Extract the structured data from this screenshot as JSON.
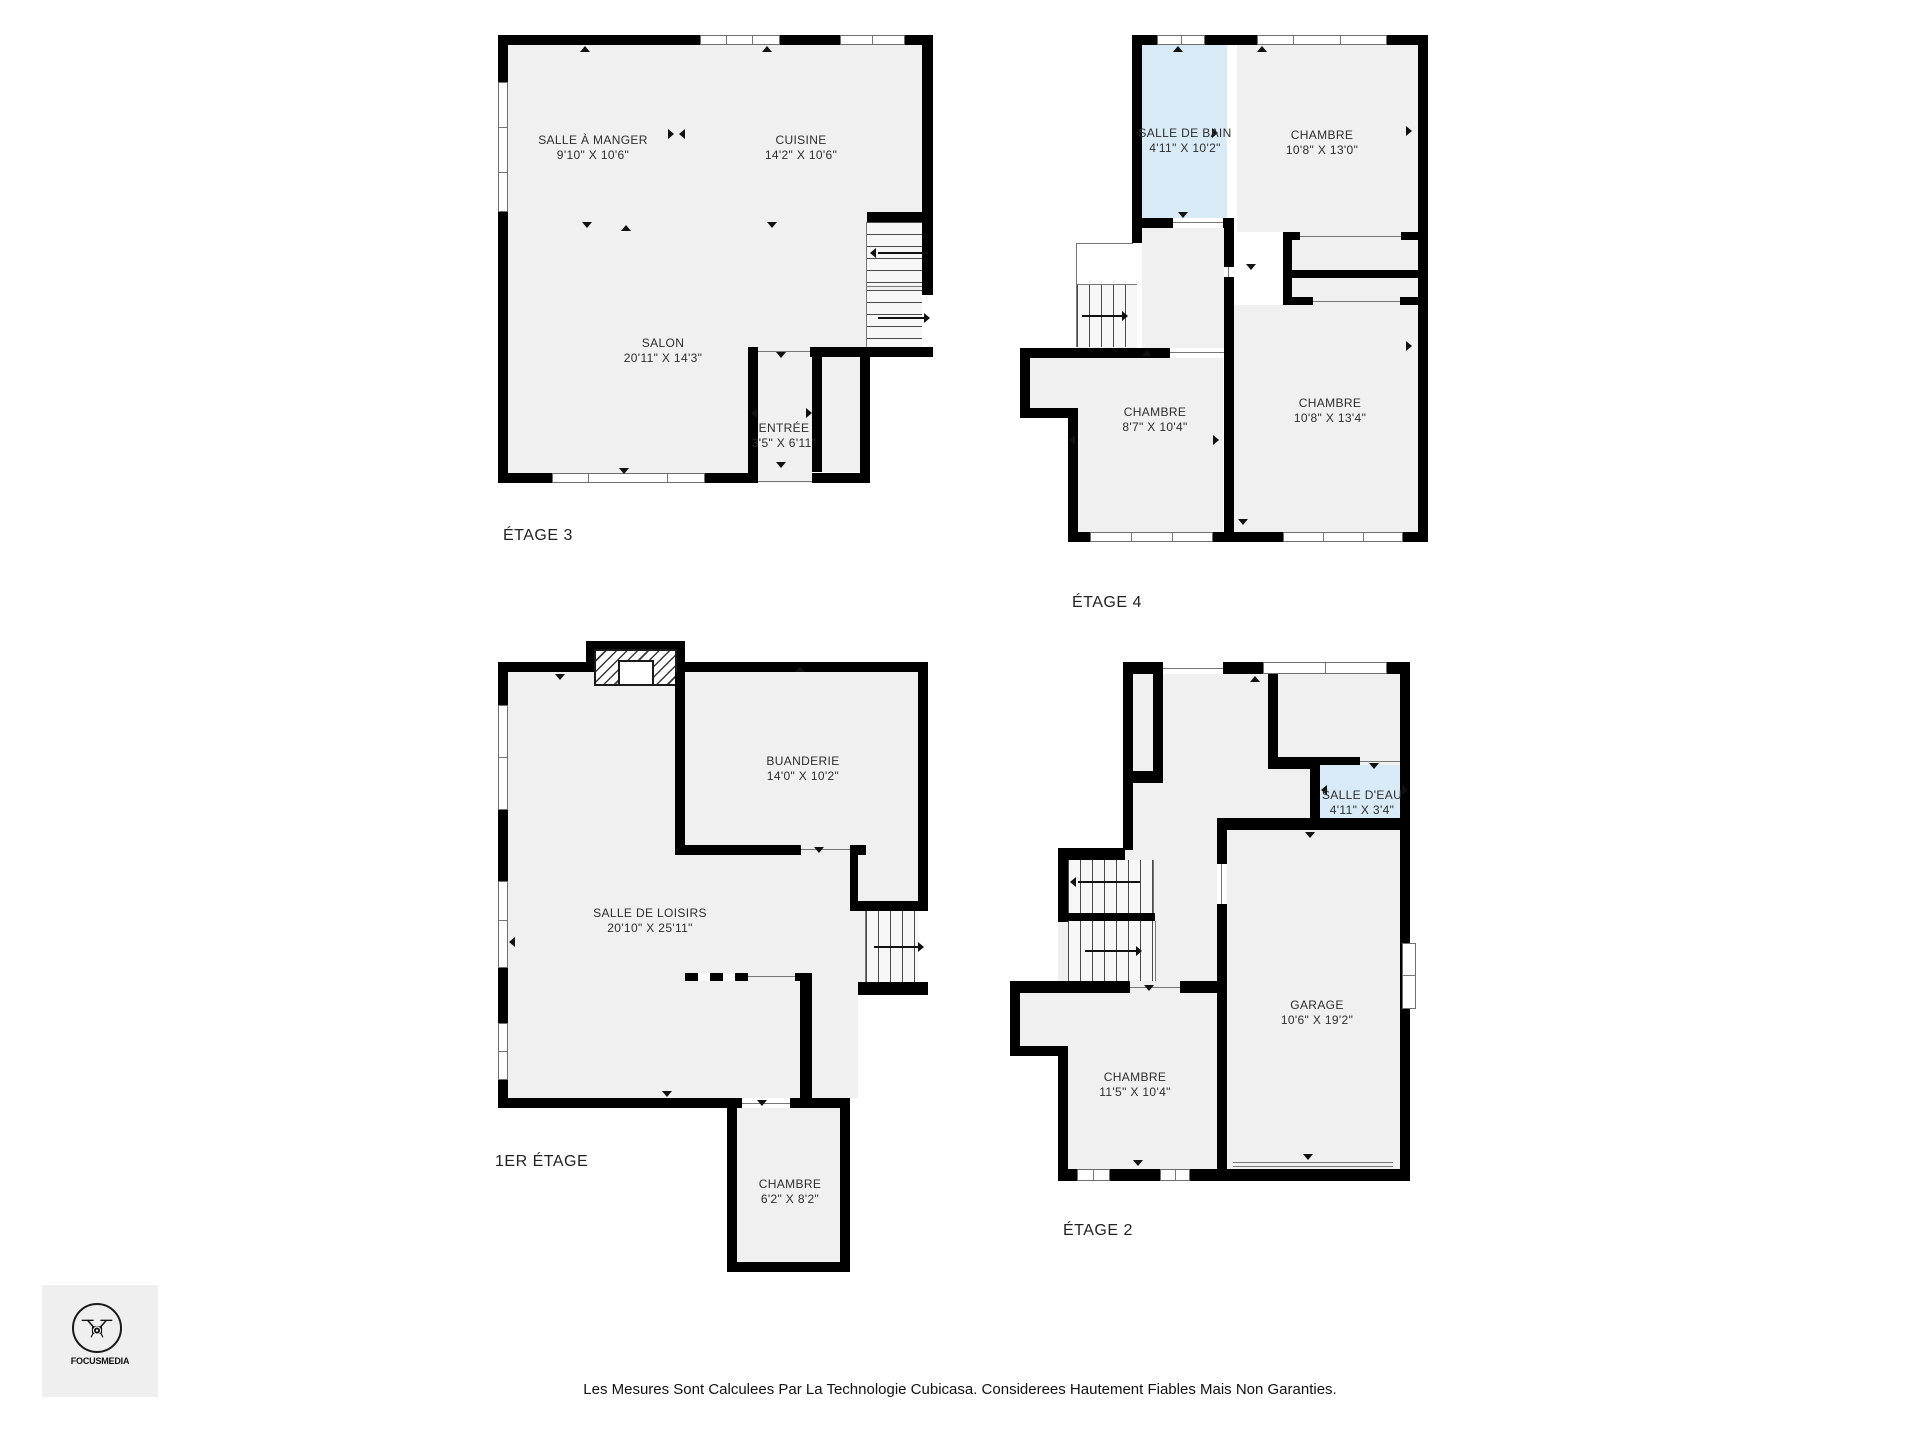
{
  "colors": {
    "wall": "#000000",
    "floor": "#f0f0f0",
    "water_room": "#d9eaf7"
  },
  "logo": {
    "brand": "FOCUSMEDIA"
  },
  "footer": {
    "disclaimer": "Les Mesures Sont Calculees Par La Technologie Cubicasa. Considerees Hautement Fiables Mais Non Garanties."
  },
  "plans": [
    {
      "id": "etage3",
      "label": "ÉTAGE 3",
      "rooms": [
        {
          "name": "SALLE À MANGER",
          "dims": "9'10\" X 10'6\""
        },
        {
          "name": "CUISINE",
          "dims": "14'2\" X 10'6\""
        },
        {
          "name": "SALON",
          "dims": "20'11\" X 14'3\""
        },
        {
          "name": "ENTRÉE",
          "dims": "3'5\" X 6'11\""
        }
      ]
    },
    {
      "id": "etage4",
      "label": "ÉTAGE 4",
      "rooms": [
        {
          "name": "SALLE DE BAIN",
          "dims": "4'11\" X 10'2\""
        },
        {
          "name": "CHAMBRE",
          "dims": "10'8\" X 13'0\""
        },
        {
          "name": "CHAMBRE",
          "dims": "8'7\" X 10'4\""
        },
        {
          "name": "CHAMBRE",
          "dims": "10'8\" X 13'4\""
        }
      ]
    },
    {
      "id": "etage1",
      "label": "1ER ÉTAGE",
      "rooms": [
        {
          "name": "BUANDERIE",
          "dims": "14'0\" X 10'2\""
        },
        {
          "name": "SALLE DE LOISIRS",
          "dims": "20'10\" X 25'11\""
        },
        {
          "name": "CHAMBRE",
          "dims": "6'2\" X 8'2\""
        }
      ]
    },
    {
      "id": "etage2",
      "label": "ÉTAGE 2",
      "rooms": [
        {
          "name": "SALLE D'EAU",
          "dims": "4'11\" X 3'4\""
        },
        {
          "name": "GARAGE",
          "dims": "10'6\" X 19'2\""
        },
        {
          "name": "CHAMBRE",
          "dims": "11'5\" X 10'4\""
        }
      ]
    }
  ]
}
